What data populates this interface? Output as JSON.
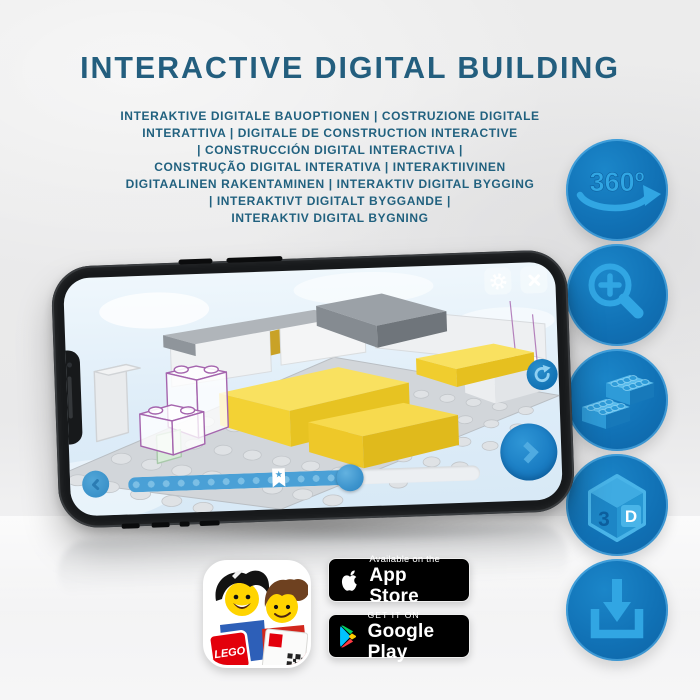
{
  "title": "INTERACTIVE DIGITAL BUILDING",
  "subtitle": {
    "lines": [
      "INTERAKTIVE DIGITALE BAUOPTIONEN | COSTRUZIONE DIGITALE",
      "INTERATTIVA | DIGITALE DE CONSTRUCTION INTERACTIVE",
      "| CONSTRUCCIÓN DIGITAL INTERACTIVA |",
      "CONSTRUÇÃO DIGITAL INTERATIVA | INTERAKTIIVINEN",
      "DIGITAALINEN RAKENTAMINEN | INTERAKTIV DIGITAL BYGGING",
      "| INTERAKTIVT DIGITALT BYGGANDE |",
      "INTERAKTIV DIGITAL BYGNING"
    ]
  },
  "features": {
    "rotate_360": {
      "label": "360º",
      "icon": "rotate-360-icon"
    },
    "zoom_in": {
      "icon": "magnifier-plus-icon"
    },
    "bricks": {
      "icon": "lego-bricks-icon"
    },
    "cube_3d": {
      "label_3": "3",
      "label_d": "D",
      "icon": "3d-cube-icon"
    },
    "download": {
      "icon": "download-icon"
    }
  },
  "phone": {
    "slider": {
      "progress_percent": 63,
      "bookmark_percent": 41,
      "star": "★"
    }
  },
  "badges": {
    "app_store": {
      "line1": "Available on the",
      "line2": "App Store"
    },
    "google_play": {
      "line1": "GET IT ON",
      "line2": "Google Play"
    }
  },
  "app_icon": {
    "lego_logo": "LEGO"
  },
  "colors": {
    "title_blue": "#235e7e",
    "icon_circle_blue": "#1172b6",
    "icon_glyph_blue": "#31a6e3",
    "screen_sky": "#ddecf8",
    "slider_blue": "#4aa0d6",
    "brick_yellow": "#f5d83f",
    "outline_purple": "#a565ae",
    "lego_red": "#e3000b",
    "badge_black": "#000000"
  }
}
